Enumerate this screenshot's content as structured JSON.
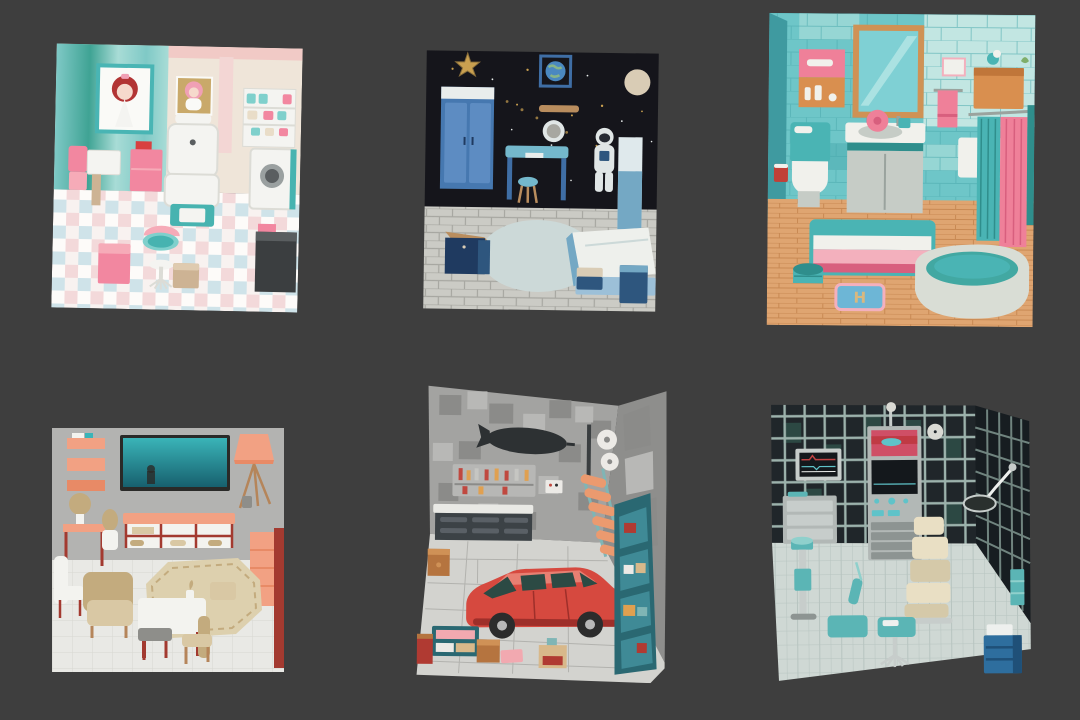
{
  "page": {
    "background": "#3e3e3e",
    "description": "Grid of six isometric 3D miniature room renders on a dark gray background"
  },
  "rooms": [
    {
      "id": "doll-salon",
      "label": "pastel doll bedroom with posters, salon chair, cake shelf and checkered floor",
      "items": [
        "doll-poster-red-hair",
        "doll-poster-bonnet",
        "salon-chair",
        "cake-shelf",
        "washing-machine",
        "dark-counter",
        "pink-cabinet",
        "side-table",
        "pink-bench",
        "pink-cube-stool",
        "teal-round-table",
        "pedestal-chair",
        "tan-cube-stool"
      ],
      "palette": {
        "wallTealDeep": "#3fa394",
        "wallTealMid": "#7fc9c6",
        "wallTealLight": "#a8dcd6",
        "wallCream": "#efe5d9",
        "wallPink": "#f1cac6",
        "stripePink": "#f3d6d4",
        "frameTeal": "#49b5b4",
        "posterWhite": "#fafaf7",
        "hairRed": "#b23434",
        "skin": "#f6d9cc",
        "posterTan": "#c9a96a",
        "bonnetPink": "#f0a0b5",
        "white": "#f4f4f1",
        "whiteShade": "#dcdcd6",
        "teal": "#47b3b0",
        "tealLight": "#7fd0cc",
        "pink": "#f287a0",
        "pinkLight": "#f6abb8",
        "red": "#d84040",
        "tan": "#cdb394",
        "tanLight": "#dfcbb0",
        "grayDark": "#3b3e40",
        "grayMid": "#5a5e60",
        "gray": "#9aa0a0",
        "cream": "#e9ddc8",
        "floorA": "#f8f2f0",
        "floorB": "#cfe3e9",
        "floorC": "#f3d9da",
        "floorD": "#fdfbf9"
      }
    },
    {
      "id": "space-bedroom",
      "label": "space themed bedroom with starry wall, astronaut, blue wardrobe, desk and bed",
      "items": [
        "gold-star",
        "earth-picture",
        "moon-planet",
        "wall-shelf",
        "porthole-mirror",
        "star-field",
        "blue-wardrobe",
        "blue-desk",
        "stool",
        "astronaut-figure",
        "bookcase",
        "bed",
        "footstool",
        "nightstand",
        "navy-dresser",
        "pale-rug"
      ],
      "palette": {
        "sky": "#15151b",
        "gold": "#c9a050",
        "goldDim": "#8a6f3a",
        "white": "#e9edec",
        "frameBlue": "#3f6ea5",
        "earthBlue": "#4a88c0",
        "earthLand": "#86b488",
        "moon": "#d9ccb5",
        "blue": "#4678b0",
        "blueLight": "#5d8cc2",
        "bluePale": "#9cc0d8",
        "desk": "#74b8cc",
        "wood": "#b98d5e",
        "navy": "#1f3a60",
        "navyLight": "#2e567e",
        "astro": "#e0e6e6",
        "visor": "#262b33",
        "floor": "#cbcbc5",
        "grout": "#a7a7a1",
        "rug": "#ccd9d8",
        "bedWhite": "#eef0ec",
        "bedBlue": "#74a8c4",
        "shelfPale": "#dfe9ec"
      }
    },
    {
      "id": "bathroom",
      "label": "teal tiled bathroom with mirror, vanity, toilet, shower curtains, striped rug and bathtub",
      "mat_monogram": "H",
      "items": [
        "wood-frame-mirror",
        "medicine-cabinet",
        "toilet",
        "red-cup",
        "vanity-sink",
        "pink-flower",
        "pink-towel",
        "wall-art",
        "orange-cabinet",
        "bird-figure",
        "shower-curtains",
        "striped-rug",
        "teal-stool",
        "monogram-mat",
        "bathtub"
      ],
      "palette": {
        "tile": "#6ec6c8",
        "tileLight": "#96d6d4",
        "tilePale": "#c2e6e2",
        "tileDark": "#4aa9ad",
        "sideWall": "#3f9aa0",
        "frameWood": "#cf9255",
        "mirror": "#7fd0d4",
        "mirrorLight": "#abe2e2",
        "pink": "#ef8099",
        "pinkLight": "#f3b0bd",
        "pinkDeep": "#d85f7e",
        "orange": "#d98f4f",
        "orangeDark": "#c0763a",
        "white": "#f1f1ec",
        "gray": "#c6ccc6",
        "grayDark": "#9aa39e",
        "teal": "#4ab4b4",
        "tealDeep": "#2f8e8c",
        "red": "#c04038",
        "woodFloor": "#dfa571",
        "woodDark": "#c88953",
        "tubOuter": "#d9ddd5",
        "tubInner": "#42a8a2",
        "matBlue": "#6db6d6",
        "matTan": "#d9b87f",
        "green": "#7fae6a"
      }
    },
    {
      "id": "living-room",
      "label": "living room with wall TV, salmon shelves, tripod lamp, sideboard, armchair and dining set",
      "items": [
        "wall-shelves",
        "tv",
        "tripod-lamp",
        "sideboard",
        "console-table",
        "ball-lamp",
        "vase",
        "tall-cabinet",
        "white-chair",
        "armchair",
        "octagon-rug",
        "dining-table",
        "dining-chairs",
        "table-plant"
      ],
      "palette": {
        "wall": "#b3b3b1",
        "floor": "#e9e9e5",
        "grout": "#d7d7d1",
        "tvFrame": "#2a2a28",
        "tvTop": "#3ab4b8",
        "tvBottom": "#17606e",
        "salmon": "#f2a183",
        "salmonDeep": "#e88a66",
        "red": "#a33a30",
        "beige": "#c3ab7e",
        "beigeLight": "#d9c8a4",
        "white": "#f3f3ef",
        "wood": "#b5855a",
        "grayItem": "#8e8e8a",
        "rug": "#ddd0ae"
      }
    },
    {
      "id": "garage",
      "label": "garage with block walls, blimp silhouette, tool pegboard, workbench, red car and shelves",
      "items": [
        "blimp-silhouette",
        "tool-pegboard",
        "control-panel",
        "wall-pipe",
        "paper-rolls",
        "orange-step-ladder",
        "workbench",
        "red-car",
        "wall-shelf-unit",
        "teal-shelf",
        "red-cabinet",
        "brown-crate",
        "brown-cube",
        "pink-mat",
        "tan-box"
      ],
      "palette": {
        "wall": "#a3a3a1",
        "blockDark": "#8b8b89",
        "blockLight": "#b8b8b6",
        "sideWall": "#8e8e8c",
        "floor": "#d3d3cf",
        "floorLine": "#b2b2ae",
        "blimp": "#2d3133",
        "white": "#eceae6",
        "board": "#b7b7b5",
        "benchTop": "#e9e9e5",
        "bench": "#3c4246",
        "benchSlot": "#5a6066",
        "ladder": "#eb9a6f",
        "ladderTeal": "#7fb5b5",
        "pipe": "#3a3e40",
        "carRed": "#d6493f",
        "carRedDark": "#9e2f2a",
        "carRedLight": "#e87f72",
        "window": "#2c4a44",
        "wheel": "#2c2c2c",
        "hub": "#b8b8b8",
        "shelfTeal": "#2a6872",
        "shelfTealLight": "#3f8a96",
        "crateRed": "#b03a32",
        "brown": "#b5743f",
        "brownLight": "#cf9156",
        "pinkMat": "#f2a9b0",
        "tanBox": "#d8b88a",
        "toolRed": "#c0483f",
        "toolOrange": "#e0a050",
        "silver": "#c6c6c2"
      }
    },
    {
      "id": "clinic",
      "label": "medical exam room with metal rack walls, monitors, machine tower, exam chair and carts",
      "items": [
        "wire-rack-wall",
        "patient-monitor",
        "machine-tower",
        "wall-clock",
        "exam-lamp",
        "drawer-cart",
        "iv-scale-stand",
        "exam-chair",
        "teal-table",
        "tray-table",
        "wheeled-stool",
        "blue-cabinet",
        "teal-brush"
      ],
      "palette": {
        "dark": "#20262a",
        "darker": "#171d21",
        "rack": "#9cb2ac",
        "rackDim": "#70847f",
        "cellTint": "#2c4843",
        "silver": "#c7cdcb",
        "screenDark": "#14181c",
        "redLine": "#c04242",
        "screenPink": "#cf4f66",
        "redBand": "#c03a44",
        "tealBlob": "#5fc3c9",
        "machine": "#b2b8b6",
        "machineDark": "#8d9492",
        "clock": "#dadad4",
        "cream": "#e9dfc4",
        "creamDark": "#d5c9a9",
        "teal": "#5bb5b5",
        "tealLight": "#8fd0cc",
        "blue": "#2e6e9e",
        "blueDark": "#1f5078",
        "floor": "#cfd8d4",
        "floorLine": "#b7c4c0",
        "lampHead": "#2a302e",
        "white": "#eef0ee"
      }
    }
  ]
}
